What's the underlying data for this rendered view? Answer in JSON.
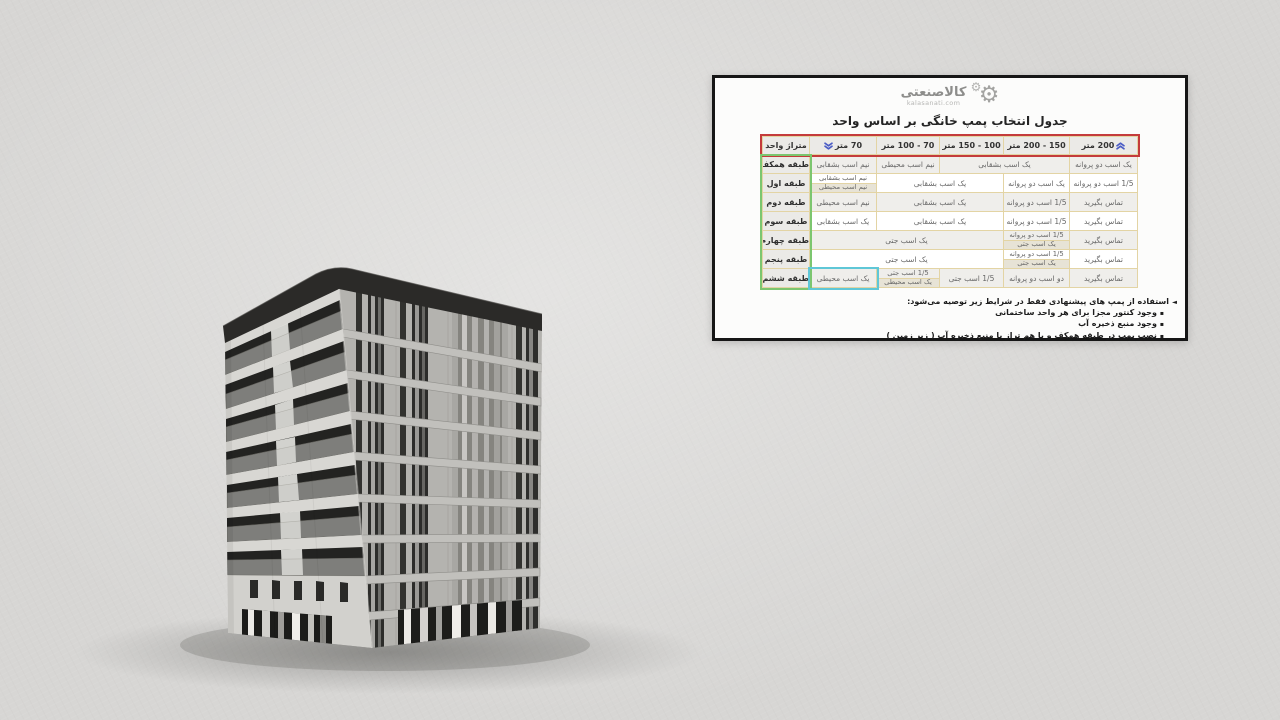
{
  "card": {
    "logo": {
      "brand": "کالاصنعتی",
      "domain": "kalasanati.com",
      "gear_icon": "⚙"
    },
    "title": "جدول انتخاب پمپ خانگی بر اساس واحد",
    "table": {
      "headers": {
        "unit_area": "متراژ واحد",
        "m70": "70 متر",
        "m70_100": "70 - 100 متر",
        "m100_150": "100 - 150 متر",
        "m150_200": "150 - 200 متر",
        "m200": "200 متر"
      },
      "rows": [
        {
          "label": "طبقه همکف",
          "cells": [
            {
              "text": "نیم اسب بشقابی"
            },
            {
              "text": "نیم اسب محیطی"
            },
            {
              "text": "یک اسب بشقابی"
            },
            {
              "text": "یک اسب دو پروانه"
            }
          ]
        },
        {
          "label": "طبقه اول",
          "cells": [
            {
              "split": [
                "نیم اسب بشقابی",
                "نیم اسب محیطی"
              ]
            },
            {
              "text": "یک اسب بشقابی"
            },
            {
              "text": "یک اسب دو پروانه"
            },
            {
              "text": "1/5 اسب دو پروانه"
            }
          ]
        },
        {
          "label": "طبقه دوم",
          "cells": [
            {
              "text": "نیم اسب محیطی"
            },
            {
              "text": "یک اسب بشقابی"
            },
            {
              "text": "1/5 اسب دو پروانه"
            },
            {
              "text": "تماس بگیرید"
            }
          ]
        },
        {
          "label": "طبقه سوم",
          "cells": [
            {
              "text": "یک اسب بشقابی"
            },
            {
              "text": "یک اسب بشقابی"
            },
            {
              "text": "1/5 اسب دو پروانه"
            },
            {
              "text": "تماس بگیرید"
            }
          ]
        },
        {
          "label": "طبقه چهارم",
          "cells": [
            {
              "text": "یک اسب جتی"
            },
            {
              "split": [
                "1/5 اسب دو پروانه",
                "یک اسب جتی"
              ]
            },
            {
              "text": "تماس بگیرید"
            }
          ]
        },
        {
          "label": "طبقه پنجم",
          "cells": [
            {
              "text": "یک اسب جتی"
            },
            {
              "split": [
                "1/5 اسب دو پروانه",
                "یک اسب جتی"
              ]
            },
            {
              "text": "تماس بگیرید"
            }
          ]
        },
        {
          "label": "طبقه ششم",
          "cells": [
            {
              "text": "یک اسب محیطی"
            },
            {
              "split": [
                "1/5 اسب جتی",
                "یک اسب محیطی"
              ]
            },
            {
              "text": "1/5 اسب جتی"
            },
            {
              "text": "دو اسب دو پروانه"
            },
            {
              "text": "تماس بگیرید"
            }
          ]
        }
      ]
    },
    "notes": {
      "bullet_intro": "◄",
      "bullet_item": "▪",
      "intro": "استفاده از پمپ های پیشنهادی فقط در شرایط زیر توصیه می‌شود:",
      "items": [
        "وجود کنتور مجزا برای هر واحد ساختمانی",
        "وجود منبع ذخیره آب",
        "نصب پمپ در طبقه همکف و یا هم تراز با منبع ذخیره آب ( زیر زمین )"
      ]
    },
    "colors": {
      "header_border": "#c43b3b",
      "label_border": "#7cc66f",
      "highlight_border": "#5fc7d7",
      "accent_blue": "#4a5cc5"
    }
  }
}
